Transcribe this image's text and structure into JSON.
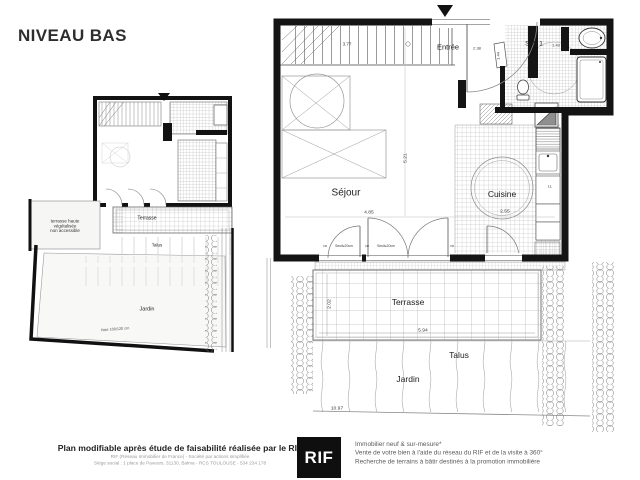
{
  "title": "NIVEAU BAS",
  "small_plan": {
    "roof_terrace_line1": "terrasse haute",
    "roof_terrace_line2": "végétalisée",
    "roof_terrace_line3": "non accessible",
    "terrasse": "Terrasse",
    "talus": "Talus",
    "jardin": "Jardin",
    "haie": "Haie 100/120 cm"
  },
  "main_plan": {
    "entree": "Entrée",
    "entree_width": "2.38",
    "entree_depth": "1.44",
    "sde": "SdE 1",
    "sde_width": "1.43",
    "stairs_width": "3.77",
    "sejour": "Séjour",
    "sejour_width": "4.85",
    "sejour_depth": "5.21",
    "cuisine": "Cuisine",
    "cuisine_width": "2.55",
    "washer": "LL",
    "seuil": "Seuil≤20cm",
    "vr": "VR",
    "terrasse": "Terrasse",
    "terrasse_width": "5.94",
    "terrasse_depth": "2.02",
    "talus": "Talus",
    "jardin": "Jardin",
    "jardin_width": "10.97"
  },
  "footer": {
    "disclaimer": "Plan modifiable après étude de faisabilité réalisée par le RIF",
    "company_line1": "RIF (Réseau Immobilier de France) - Société par actions simplifiée",
    "company_line2": "Siège social : 1 place de Paveurs, 31130, Balma - RCS TOULOUSE - 534 234 178",
    "logo": "RIF",
    "services_line1": "Immobilier neuf & sur-mesure*",
    "services_line2": "Vente de votre bien à l'aide du réseau du RIF et de la visite à 360°",
    "services_line3": "Recherche de terrains à bâtir destinés à la promotion immobilière"
  },
  "colors": {
    "wall": "#141414",
    "logo_bg": "#0f0f0f",
    "paper": "#ffffff"
  }
}
